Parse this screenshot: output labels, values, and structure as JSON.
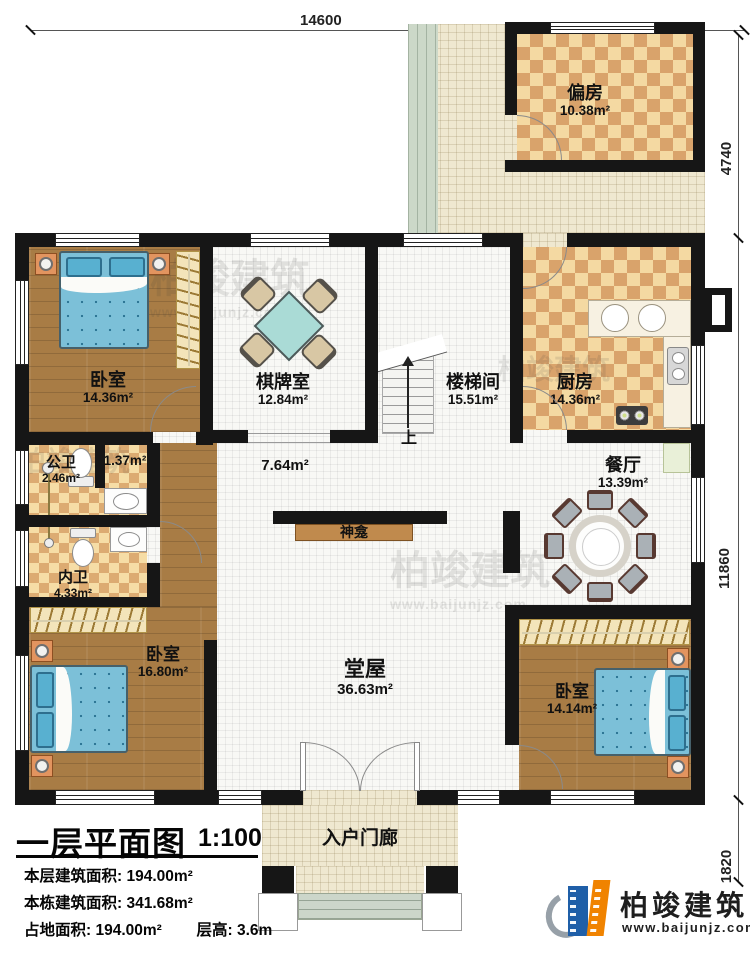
{
  "dimensions": {
    "top": "14600",
    "right_top": "4740",
    "right_middle": "11860",
    "right_bottom": "1820"
  },
  "rooms": {
    "pianfang": {
      "name": "偏房",
      "area": "10.38m²"
    },
    "bedroom1": {
      "name": "卧室",
      "area": "14.36m²"
    },
    "chess": {
      "name": "棋牌室",
      "area": "12.84m²"
    },
    "stair": {
      "name": "楼梯间",
      "area": "15.51m²"
    },
    "kitchen": {
      "name": "厨房",
      "area": "14.36m²"
    },
    "dining": {
      "name": "餐厅",
      "area": "13.39m²"
    },
    "gongwei": {
      "name": "公卫",
      "area": "2.46m²"
    },
    "neiwei": {
      "name": "内卫",
      "area": "4.33m²"
    },
    "hall": {
      "name": "堂屋",
      "area": "36.63m²"
    },
    "bedroom2": {
      "name": "卧室",
      "area": "16.80m²"
    },
    "bedroom3": {
      "name": "卧室",
      "area": "14.14m²"
    },
    "porch": {
      "name": "入户门廊"
    }
  },
  "area_labels": {
    "corridor": "7.64m²",
    "niche": "1.37m²"
  },
  "annotations": {
    "up": "上",
    "shrine": "神龛"
  },
  "title_block": {
    "title": "一层平面图",
    "scale": "1:100",
    "lines": [
      {
        "label": "本层建筑面积:",
        "value": "194.00m²"
      },
      {
        "label": "本栋建筑面积:",
        "value": "341.68m²"
      },
      {
        "label": "占地面积:",
        "value": "194.00m²"
      },
      {
        "label": "层高:",
        "value": "3.6m"
      }
    ]
  },
  "brand": {
    "name": "柏竣建筑",
    "website": "www.baijunjz.com"
  },
  "watermark": {
    "name": "柏竣建筑",
    "website": "www.baijunjz.com"
  },
  "colors": {
    "wall": "#161616",
    "checker_tan": "#d9a36b",
    "wood": "#a87c45",
    "bed_blue": "#7cc0d8",
    "brand_blue": "#1f5fa8",
    "brand_orange": "#f08300"
  }
}
